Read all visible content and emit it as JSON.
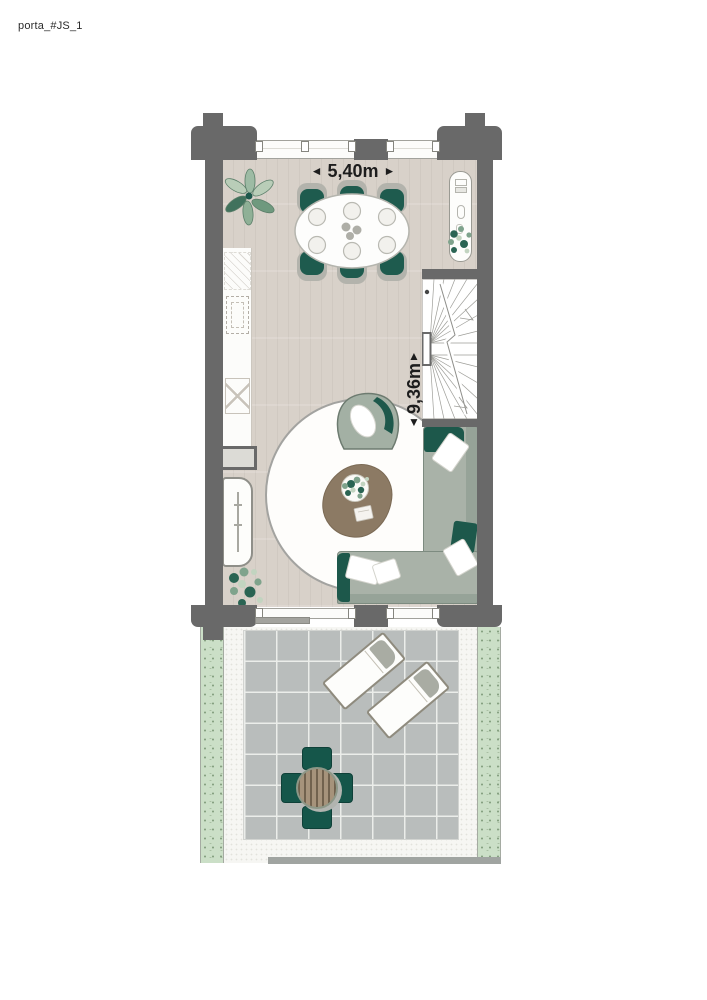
{
  "page": {
    "label": "porta_#JS_1",
    "type": "floor-plan"
  },
  "dimensions": {
    "width": {
      "value": "5,40m",
      "arrow_left": "◄",
      "arrow_right": "►"
    },
    "depth": {
      "value": "9,36m",
      "arrow_up": "▲",
      "arrow_down": "▼"
    }
  },
  "colors": {
    "wall": "#696969",
    "floor_wood": "#d8d1c9",
    "accent_teal": "#1d584b",
    "sofa_sage": "#a9b2a8",
    "rug": "#fefdfb",
    "coffee_table_brown": "#8c7a64",
    "terrace_tile": "#b9bdbc",
    "planting_green": "#cbdfc7",
    "terrace_wood": "#a6937b"
  },
  "rooms": {
    "living_dining": {
      "items": [
        "dining-table-with-six-chairs",
        "kitchen-counter",
        "low-cabinet",
        "sideboard",
        "console-table",
        "armchair",
        "corner-sofa",
        "coffee-table",
        "round-rug",
        "winder-staircase",
        "plant",
        "plant",
        "plant",
        "plant"
      ]
    },
    "terrace": {
      "items": [
        "sun-lounger",
        "sun-lounger",
        "round-bistro-table-with-four-chairs",
        "planting-strip",
        "planting-strip"
      ]
    }
  }
}
